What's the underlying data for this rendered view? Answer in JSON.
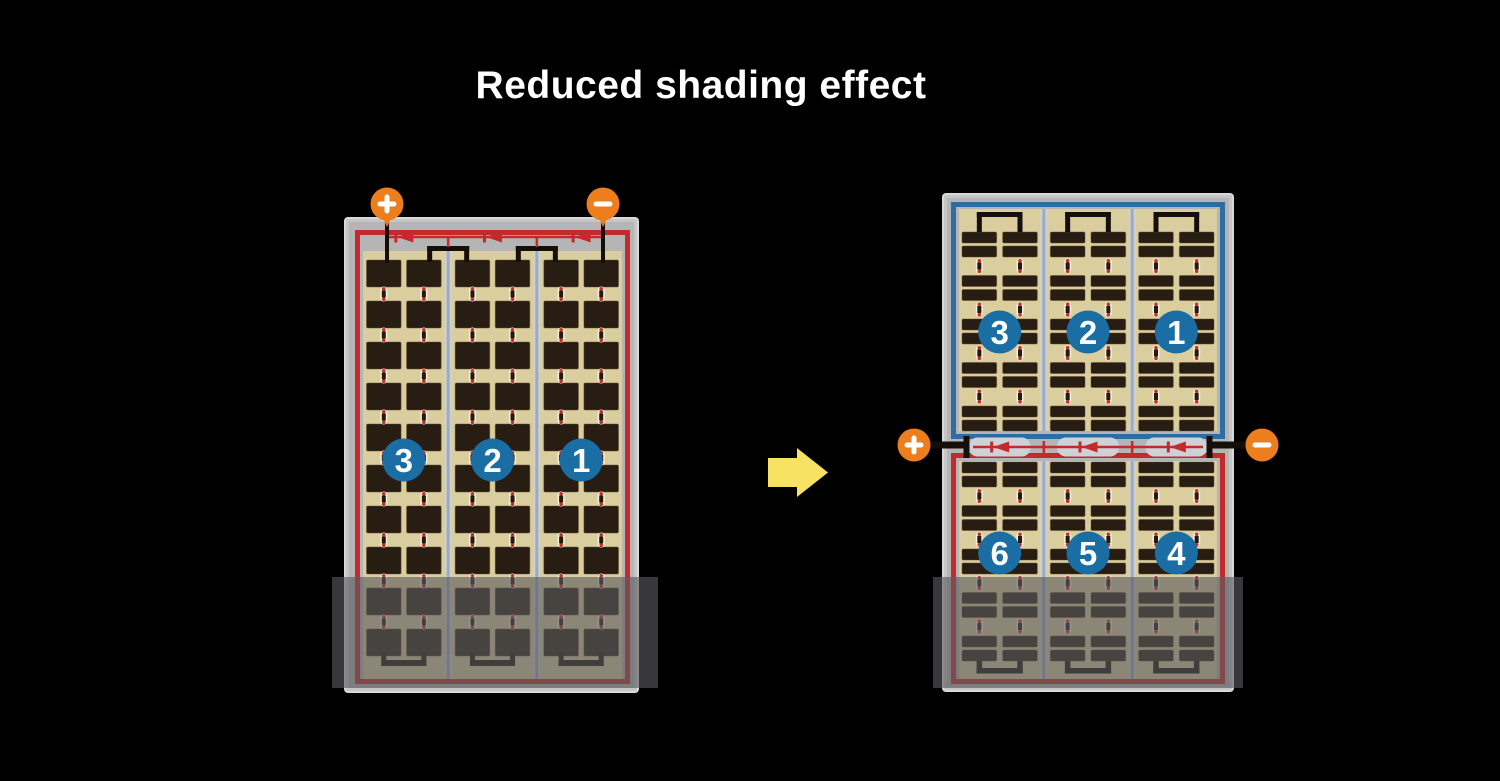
{
  "title": "Reduced shading effect",
  "colors": {
    "background": "#000000",
    "title_text": "#ffffff",
    "frame": "#c6c6c6",
    "frame_edge": "#d9d9d9",
    "frame_inner": "#b5b5b5",
    "panel_tan": "#dbce9e",
    "cell_dark": "#281d13",
    "cell_edge": "#5d4628",
    "separator_light": "#cdd1d5",
    "separator_core": "#9fabb9",
    "border_red": "#c32a2c",
    "border_blue": "#2d6da3",
    "badge_blue": "#1a6ea4",
    "badge_text": "#ffffff",
    "terminal_orange": "#ec7e1e",
    "terminal_symbol": "#ffffff",
    "wire_black": "#150f09",
    "diode_red": "#c32a2c",
    "pill_cream": "#f6efd8",
    "pill_core": "#241a10",
    "pill_dot": "#c52b31",
    "junction_housing": "#ced2d6",
    "arrow_yellow": "#f7e263",
    "shade_overlay": "rgba(90,90,94,0.62)"
  },
  "left_module": {
    "badges": [
      "3",
      "2",
      "1"
    ],
    "terminals": {
      "plus": "+",
      "minus": "−"
    }
  },
  "right_module": {
    "top_badges": [
      "3",
      "2",
      "1"
    ],
    "bottom_badges": [
      "6",
      "5",
      "4"
    ],
    "terminals": {
      "plus": "+",
      "minus": "−"
    }
  },
  "icons": {
    "plus_terminal": "plus-circle-icon",
    "minus_terminal": "minus-circle-icon",
    "diode": "bypass-diode-left-icon",
    "transition": "right-arrow-icon",
    "shading": "shade-overlay"
  }
}
